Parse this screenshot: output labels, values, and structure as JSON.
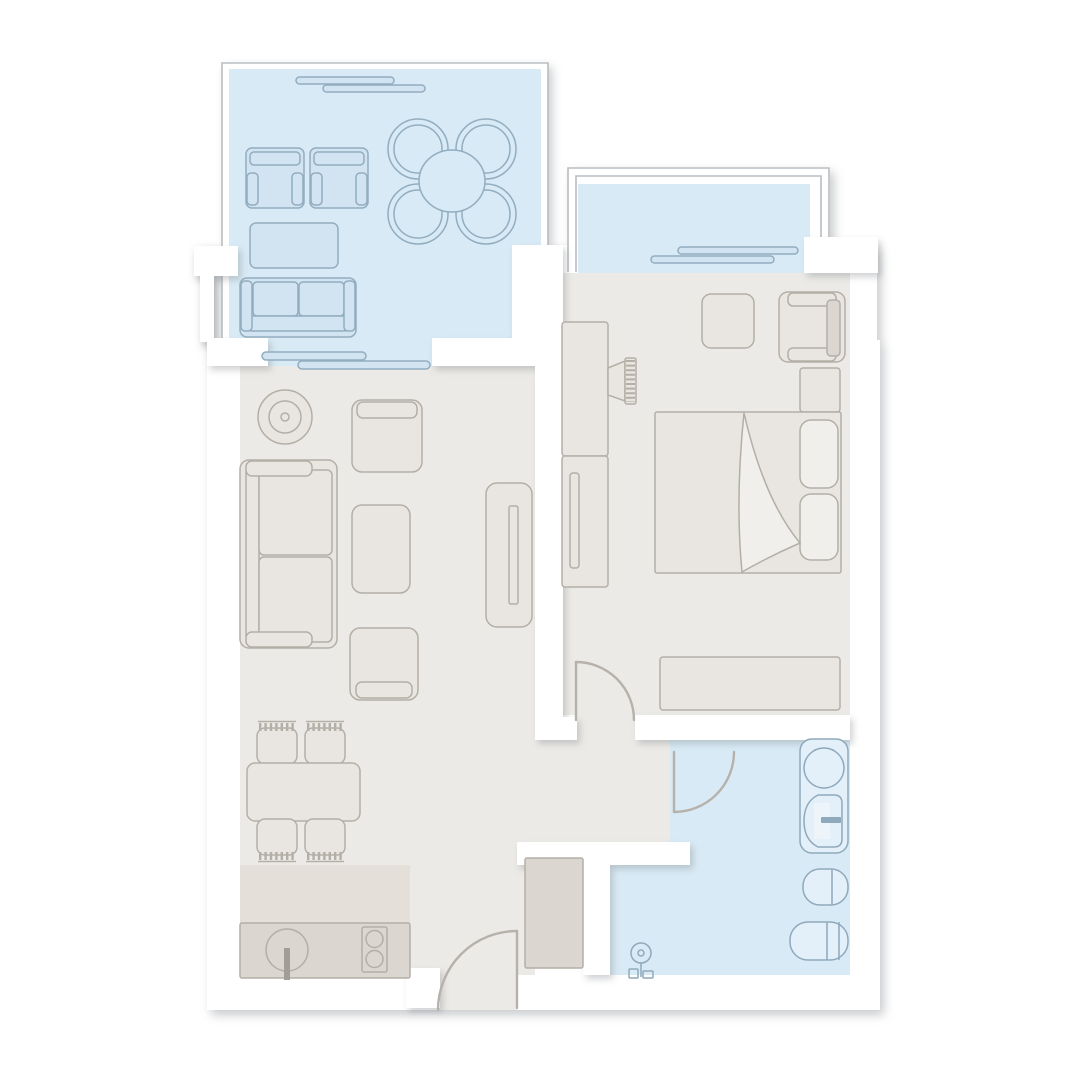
{
  "page": {
    "title": "Apartment floor plan"
  },
  "canvas": {
    "width": 1080,
    "height": 1080
  },
  "palette": {
    "background": "#ffffff",
    "wall": "#ffffff",
    "wall_shadow": "#82878d",
    "floor_warm": "#eceae6",
    "floor_warm_dark": "#e4dfd8",
    "floor_cool": "#d8eaf5",
    "furn_warm_fill": "#e9e6e1",
    "furn_warm_dark": "#dbd7d0",
    "furn_warm_stroke": "#b3afa7",
    "furn_cool_fill": "#d2e4f1",
    "furn_cool_stroke": "#92adc0",
    "fixture_fill": "#e3f0f9",
    "fixture_stroke": "#8fa9bc",
    "railing_stroke": "#b9bdc0",
    "door_stroke": "#b6b2ab",
    "accent_gray": "#a29d95"
  },
  "rooms": [
    {
      "id": "living-balcony",
      "label": "Living room balcony",
      "floor": "cool",
      "furniture": [
        "balcony-armchair",
        "balcony-armchair",
        "balcony-coffee-table",
        "balcony-loveseat",
        "round-table-with-four-chairs",
        "sliding-door",
        "sliding-door"
      ]
    },
    {
      "id": "bedroom-balcony",
      "label": "Bedroom balcony",
      "floor": "cool",
      "furniture": [
        "sliding-door"
      ]
    },
    {
      "id": "living-room",
      "label": "Living room with open kitchen",
      "floor": "warm",
      "furniture": [
        "floor-lamp",
        "armchair",
        "coffee-table",
        "sofa",
        "ottoman-armchair",
        "tv-sideboard",
        "dining-table",
        "dining-chair",
        "dining-chair",
        "dining-chair",
        "dining-chair",
        "kitchen-counter",
        "kitchen-sink",
        "cooktop"
      ]
    },
    {
      "id": "bedroom",
      "label": "Bedroom",
      "floor": "warm",
      "furniture": [
        "wardrobe",
        "wall-tv",
        "side-stool",
        "armchair",
        "nightstand",
        "double-bed",
        "dresser"
      ]
    },
    {
      "id": "bathroom",
      "label": "Bathroom",
      "floor": "cool",
      "furniture": [
        "washbasin-vanity",
        "toilet",
        "bidet",
        "shower-mixer"
      ]
    },
    {
      "id": "hallway",
      "label": "Hallway / entrance",
      "floor": "warm",
      "furniture": [
        "entry-closet"
      ]
    }
  ],
  "doors": [
    {
      "id": "entrance-door",
      "label": "Entrance door"
    },
    {
      "id": "bedroom-door",
      "label": "Bedroom door"
    },
    {
      "id": "bathroom-door",
      "label": "Bathroom door"
    }
  ]
}
